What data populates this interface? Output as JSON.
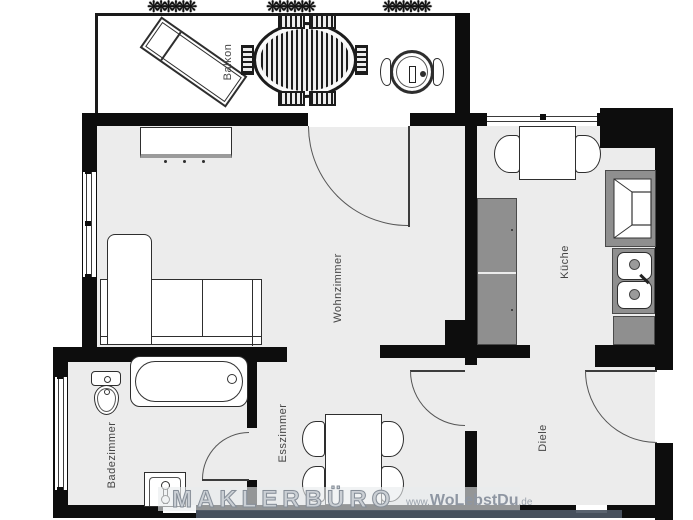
{
  "floorplan": {
    "rooms": {
      "balkon": {
        "label": "Balkon"
      },
      "wohnzimmer": {
        "label": "Wohnzimmer"
      },
      "kueche": {
        "label": "Küche"
      },
      "badezimmer": {
        "label": "Badezimmer"
      },
      "esszimmer": {
        "label": "Esszimmer"
      },
      "diele": {
        "label": "Diele"
      }
    },
    "watermark": {
      "brand": "MAKLERBÜRO",
      "url_prefix": "www.",
      "url_main": "WoLebstDu",
      "url_suffix": ".de"
    },
    "plant_glyph": "❋❋❋❋❋❋",
    "colors": {
      "wall": "#0d0d0d",
      "floor": "#ececec",
      "counter_gray": "#8f8f8f",
      "label_text": "#454545",
      "watermark_bar": "#4c5664"
    }
  }
}
